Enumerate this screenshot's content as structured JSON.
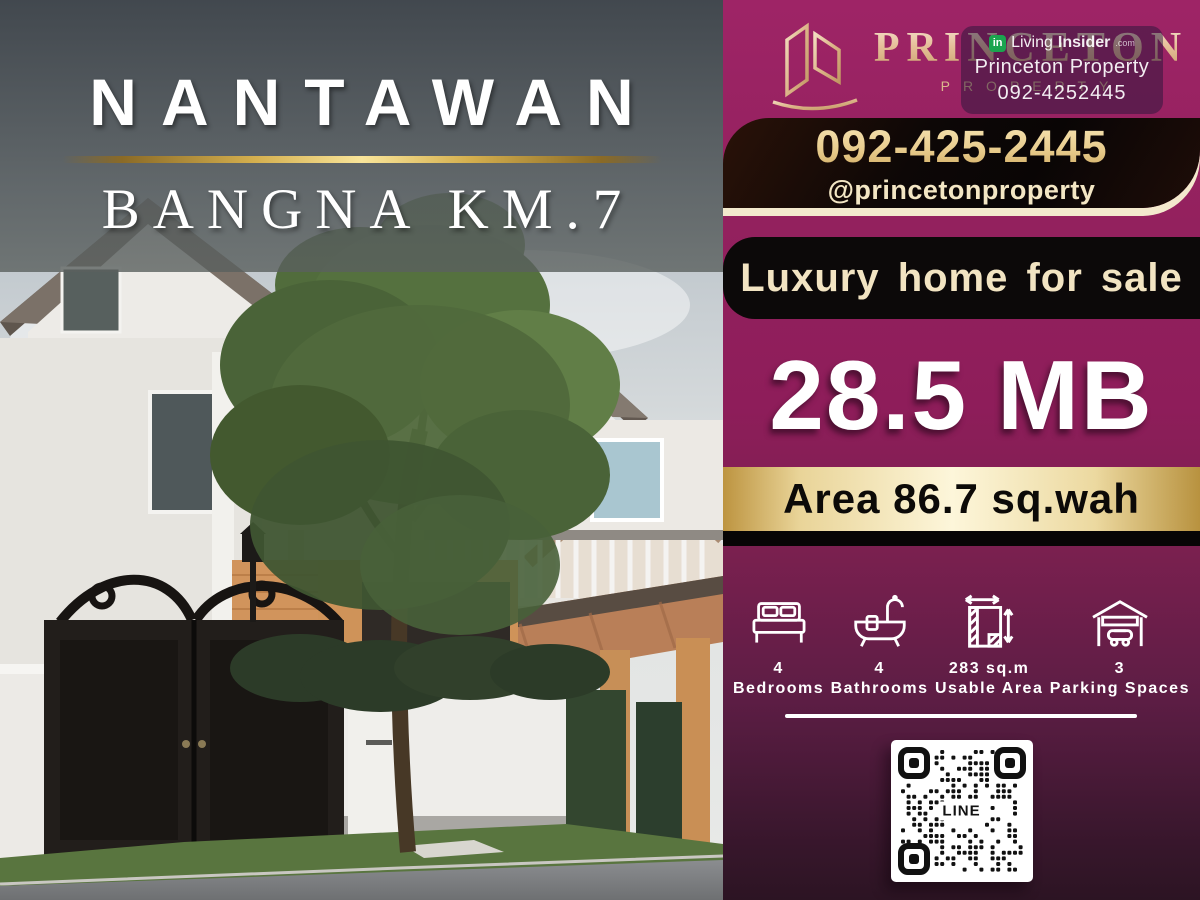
{
  "hero": {
    "project_name": "NANTAWAN",
    "location": "BANGNA KM.7"
  },
  "brand": {
    "name": "PRINCETON",
    "subtitle": "PROPERTY",
    "logo_icon": "buildings-logo-icon",
    "phone": "092-425-2445",
    "social_handle": "@princetonproperty"
  },
  "watermark": {
    "site_light": "Living",
    "site_bold": "Insider",
    "site_suffix": ".com",
    "agency": "Princeton Property",
    "phone": "092-4252445"
  },
  "listing": {
    "headline": "Luxury home for sale",
    "price": "28.5 MB",
    "area": "Area 86.7 sq.wah"
  },
  "features": [
    {
      "icon": "bed-icon",
      "value": "4",
      "label": "Bedrooms"
    },
    {
      "icon": "bathtub-icon",
      "value": "4",
      "label": "Bathrooms"
    },
    {
      "icon": "floor-area-icon",
      "value": "283 sq.m",
      "label": "Usable Area"
    },
    {
      "icon": "garage-icon",
      "value": "3",
      "label": "Parking Spaces"
    }
  ],
  "qr": {
    "label": "LINE"
  },
  "colors": {
    "panel_magenta": "#8e1d5a",
    "panel_dark_bottom": "#2c1423",
    "gold": "#d4af4e",
    "cream": "#f3e9cd",
    "black_box": "#0c0909",
    "white": "#ffffff"
  }
}
